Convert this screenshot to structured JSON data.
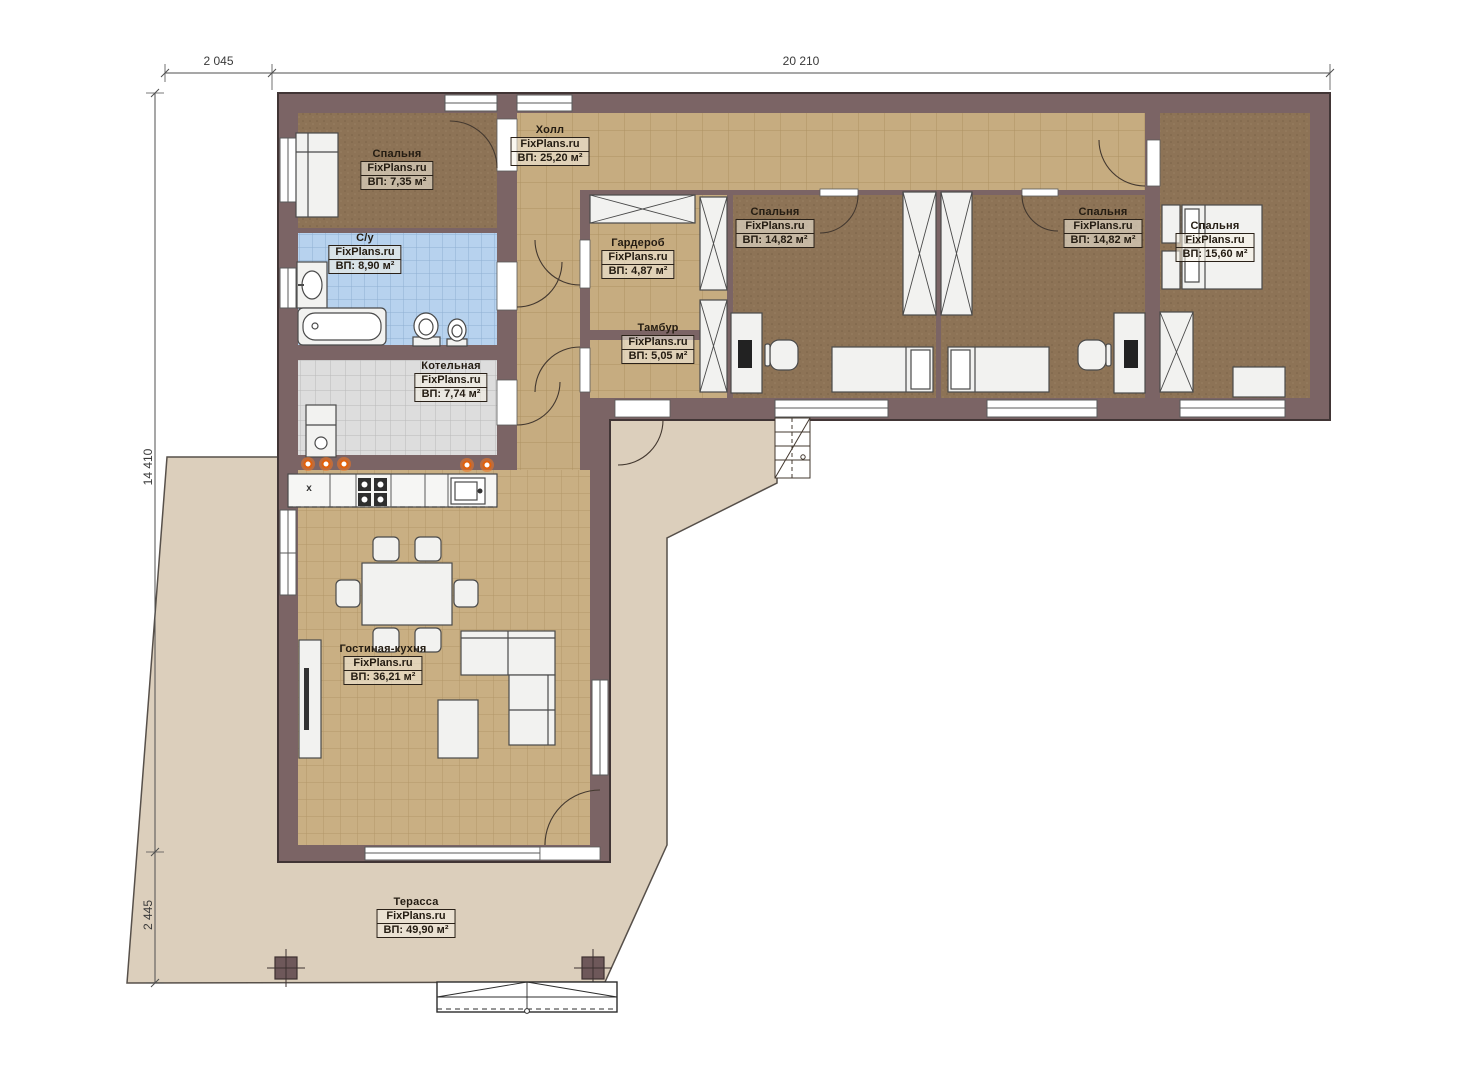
{
  "page": {
    "background": "#ffffff",
    "type": "floor-plan"
  },
  "brand": "FixPlans.ru",
  "rooms": [
    {
      "id": "bedroom-1",
      "name": "Спальня",
      "brand": "FixPlans.ru",
      "area": "ВП: 7,35 м²"
    },
    {
      "id": "hall",
      "name": "Холл",
      "brand": "FixPlans.ru",
      "area": "ВП: 25,20 м²"
    },
    {
      "id": "bathroom",
      "name": "С/у",
      "brand": "FixPlans.ru",
      "area": "ВП: 8,90 м²"
    },
    {
      "id": "wardrobe",
      "name": "Гардероб",
      "brand": "FixPlans.ru",
      "area": "ВП: 4,87 м²"
    },
    {
      "id": "boiler-room",
      "name": "Котельная",
      "brand": "FixPlans.ru",
      "area": "ВП: 7,74 м²"
    },
    {
      "id": "vestibule",
      "name": "Тамбур",
      "brand": "FixPlans.ru",
      "area": "ВП: 5,05 м²"
    },
    {
      "id": "bedroom-2",
      "name": "Спальня",
      "brand": "FixPlans.ru",
      "area": "ВП: 14,82 м²"
    },
    {
      "id": "bedroom-3",
      "name": "Спальня",
      "brand": "FixPlans.ru",
      "area": "ВП: 14,82 м²"
    },
    {
      "id": "bedroom-4",
      "name": "Спальня",
      "brand": "FixPlans.ru",
      "area": "ВП: 15,60 м²"
    },
    {
      "id": "living-kitchen",
      "name": "Гостиная-кухня",
      "brand": "FixPlans.ru",
      "area": "ВП: 36,21 м²"
    },
    {
      "id": "terrace",
      "name": "Терасса",
      "brand": "FixPlans.ru",
      "area": "ВП: 49,90 м²"
    }
  ],
  "dimensions": {
    "top_left": "2 045",
    "top_main": "20 210",
    "left_main": "14 410",
    "left_bottom": "2 445"
  },
  "fixtures": {
    "dishwasher_mark": "x"
  },
  "colors": {
    "wall": "#7b6465",
    "floor_tile_tan": "#c9af83",
    "floor_carpet": "#8d7356",
    "floor_tile_blue": "#b7d2ee",
    "floor_tile_gray": "#dddddd",
    "terrace": "#dccfbc",
    "fixture_white": "#f2f2f0",
    "accent_orange": "#f4751f",
    "line_dark": "#43382f"
  }
}
